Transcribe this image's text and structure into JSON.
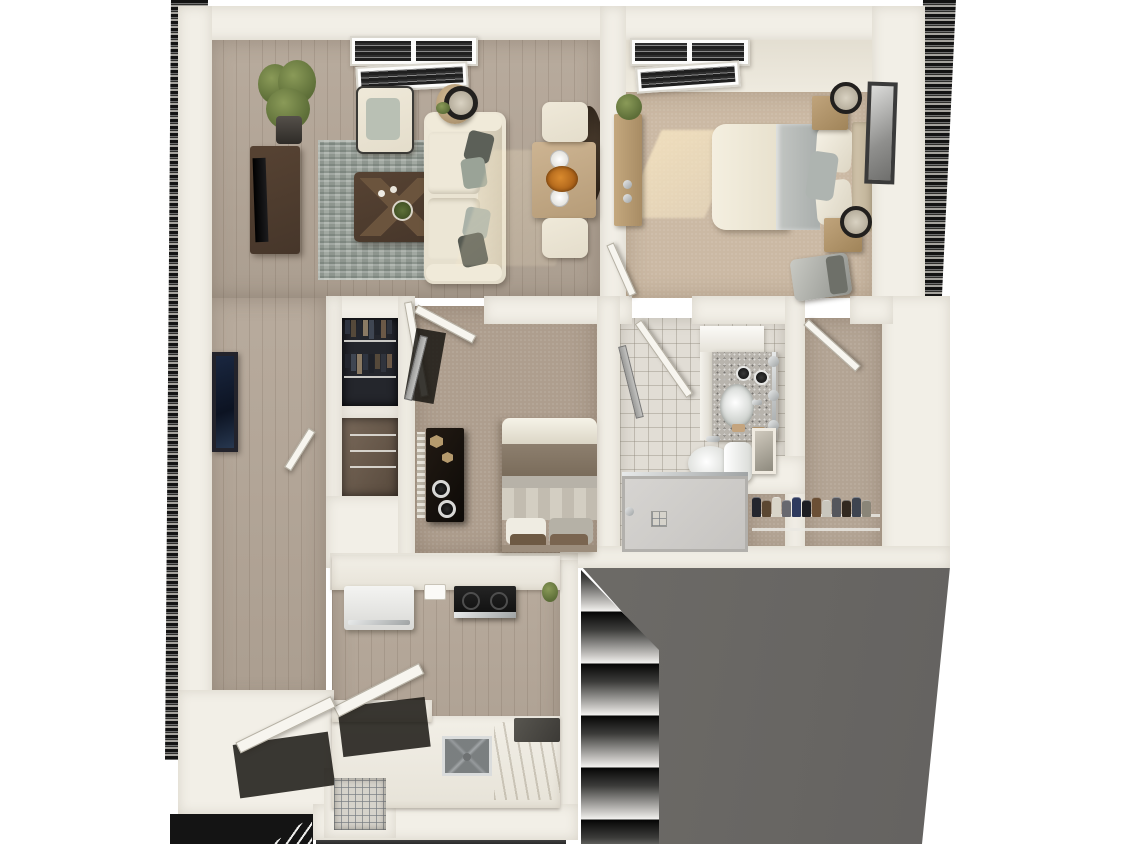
{
  "scene": {
    "description": "3D top-down dollhouse rendering of a two-bedroom one-bath apartment floor plan with living room, dining nook, galley kitchen, hall closets, walk-in closet, exterior stair flights and a gray lower-roof area",
    "view": "top-down 3D render",
    "visible_text": ""
  },
  "palette": {
    "wall": "#f2efe7",
    "wood": "#ab9e90",
    "carpet1": "#cbb9a4",
    "carpet2": "#ae9e8e",
    "carpet3": "#b3a494",
    "tile": "#e1ddd5",
    "rug": "#a2a9a2",
    "roof": "#6d6b67",
    "sofa": "#e4ddcb",
    "darkwood": "#46362a",
    "stair_dark": "#141414"
  },
  "rooms": {
    "living_room": {
      "furniture": [
        "sofa",
        "armchair",
        "coffee-table",
        "area-rug",
        "tv-console",
        "tv",
        "floor-plant",
        "side-table",
        "table-lamp",
        "window-blinds"
      ]
    },
    "dining_nook": {
      "furniture": [
        "dining-table",
        "two-chairs",
        "place-settings",
        "flower-centerpiece",
        "round-mirror"
      ]
    },
    "bedroom_primary": {
      "furniture": [
        "queen-bed",
        "two-nightstands",
        "two-lamps",
        "dresser",
        "plant",
        "framed-art",
        "bench",
        "window-blinds",
        "sun-patch"
      ]
    },
    "bedroom_second": {
      "furniture": [
        "bed",
        "black-dresser",
        "speakers",
        "mirror-door"
      ]
    },
    "bathroom": {
      "furniture": [
        "vanity-cabinet",
        "granite-counter",
        "sink",
        "faucet",
        "toilet",
        "framed-art",
        "walk-in-shower",
        "towel-bar"
      ]
    },
    "kitchen": {
      "furniture": [
        "refrigerator",
        "range",
        "sink",
        "counters",
        "dishwasher-open",
        "pantry-doors",
        "wire-basket-nook"
      ]
    },
    "hall": {
      "furniture": [
        "framed-art",
        "linen-closet",
        "coat-closet"
      ]
    },
    "walk_in_closet": {
      "furniture": [
        "wire-shelf",
        "shoe-row"
      ]
    }
  },
  "walk_in_closet": {
    "shoes": {
      "colors": [
        "#23252d",
        "#5b4732",
        "#d9d5c9",
        "#67686f",
        "#2e3a5e",
        "#1c1d22",
        "#6b4f35",
        "#c9c6bd",
        "#55565c",
        "#32281f",
        "#3e4450",
        "#8a8578"
      ]
    }
  },
  "hall_closet": {
    "clothes_rows": [
      [
        "#2e3440",
        "#55493a",
        "#23262e",
        "#8a7a64",
        "#3f4652",
        "#1f2229",
        "#6b5947",
        "#30343d"
      ],
      [
        "#23262e",
        "#3f4652",
        "#8a7a64",
        "#2e3440",
        "#1f2229",
        "#55493a",
        "#30343d",
        "#6b5947"
      ]
    ]
  },
  "exterior": {
    "stair_flights": 3,
    "lower_stair_steps": 5,
    "roof_color": "#6d6b67"
  }
}
